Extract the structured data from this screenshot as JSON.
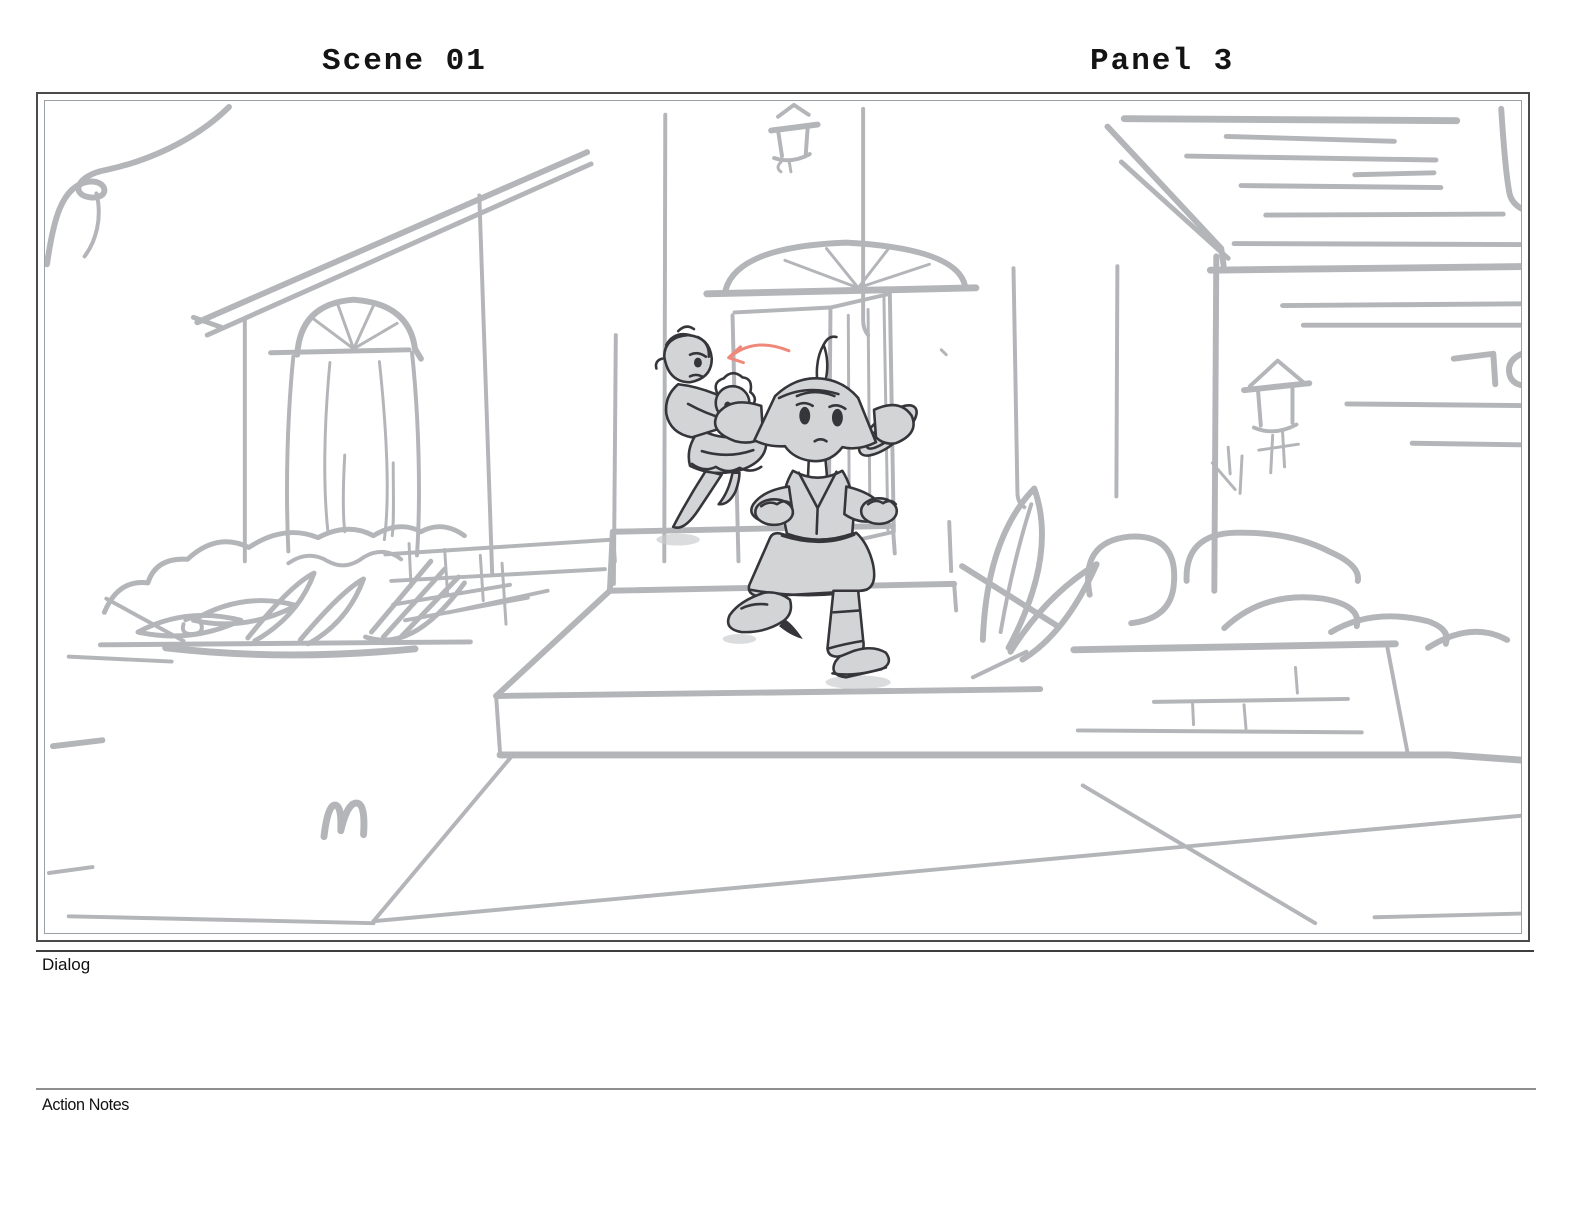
{
  "header": {
    "scene_label": "Scene 01",
    "panel_label": "Panel 3"
  },
  "panel": {
    "description": "Rough gray storyboard sketch: a girl with a leaf-sprout ponytail runs down front porch steps while a woman carrying a baby follows from the open front door; arched window house at left, roofed house with lantern post and bushes at right, sidewalk in foreground, small red direction arrow annotation",
    "colors": {
      "sketch_line": "#b3b5b8",
      "character_line": "#35353a",
      "character_fill": "#d2d4d6",
      "annotation_arrow": "#ef8878",
      "frame_border": "#4b4b4b",
      "inner_border": "#9aa0a3"
    }
  },
  "sections": {
    "dialog_label": "Dialog",
    "action_notes_label": "Action Notes"
  }
}
